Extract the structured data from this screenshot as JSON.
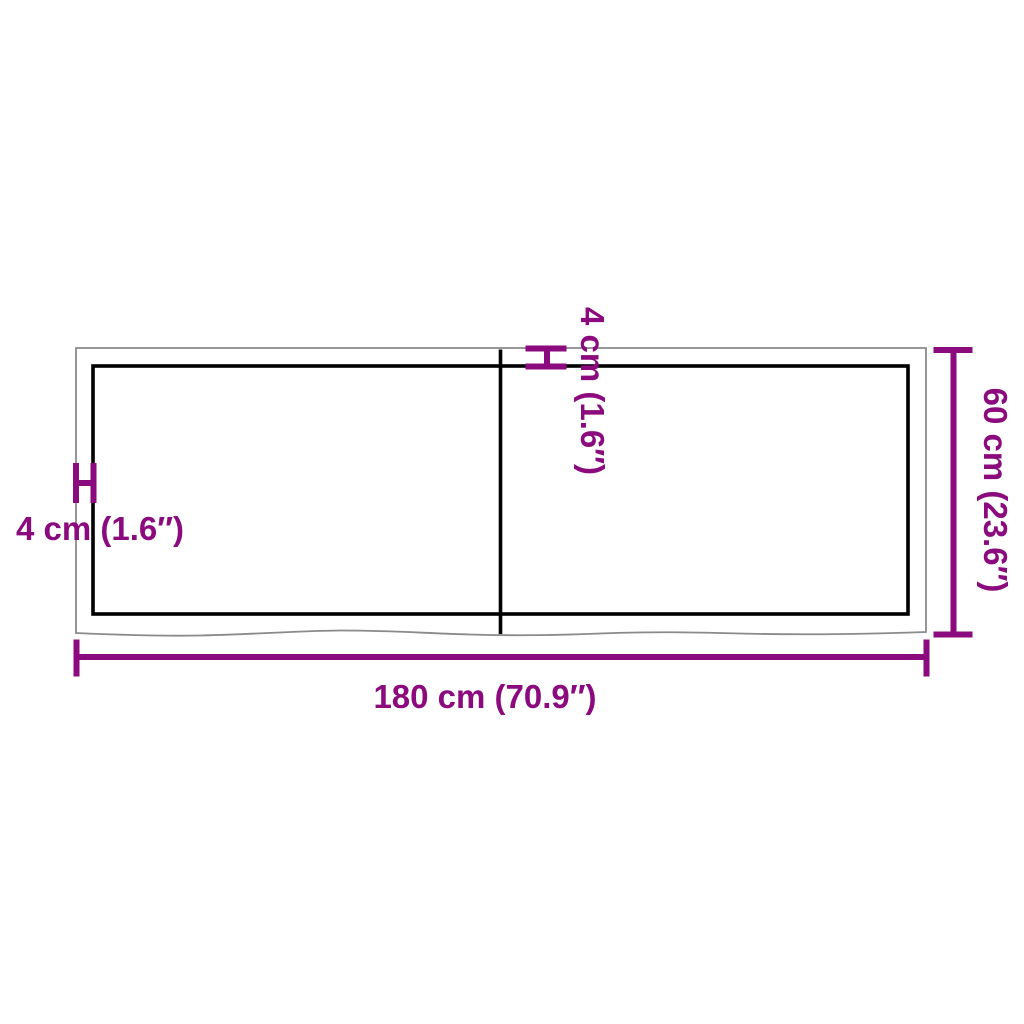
{
  "diagram": {
    "labels": {
      "top_thickness": "4 cm (1.6″)",
      "left_thickness": "4 cm (1.6″)",
      "right_height": "60 cm (23.6″)",
      "bottom_width": "180 cm (70.9″)"
    },
    "colors": {
      "dimension_magenta": "#8B0A7D",
      "outer_edge_gray": "#8A8A8A",
      "panel_black": "#000000",
      "background": "#FFFFFF"
    }
  }
}
